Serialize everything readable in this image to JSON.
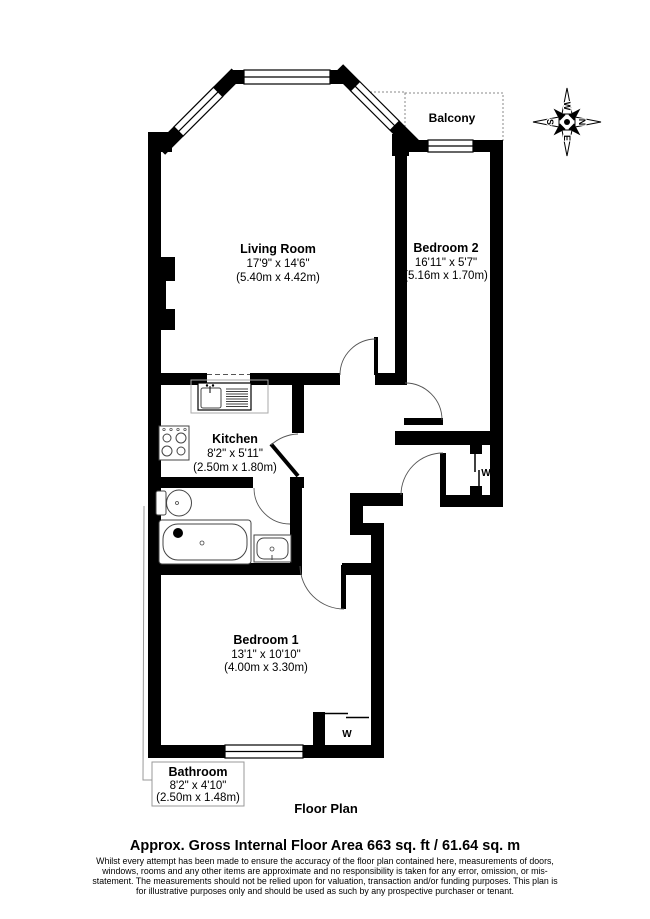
{
  "plan": {
    "rooms": [
      {
        "name": "Living Room",
        "imperial": "17'9\" x 14'6\"",
        "metric": "(5.40m x 4.42m)"
      },
      {
        "name": "Bedroom 2",
        "imperial": "16'11\" x 5'7\"",
        "metric": "(5.16m x 1.70m)"
      },
      {
        "name": "Kitchen",
        "imperial": "8'2\" x 5'11\"",
        "metric": "(2.50m x 1.80m)"
      },
      {
        "name": "Bedroom 1",
        "imperial": "13'1\" x 10'10\"",
        "metric": "(4.00m x 3.30m)"
      },
      {
        "name": "Bathroom",
        "imperial": "8'2\" x 4'10\"",
        "metric": "(2.50m x 1.48m)"
      }
    ],
    "balcony_label": "Balcony",
    "wardrobe_label": "W",
    "floor_plan_label": "Floor Plan",
    "compass": {
      "n": "N",
      "e": "E",
      "s": "S",
      "w": "W"
    }
  },
  "footer": {
    "area_title": "Approx. Gross Internal Floor Area 663 sq. ft / 61.64 sq. m",
    "disclaimer": "Whilst every attempt has been made to ensure the accuracy of the floor plan contained here, measurements of doors, windows, rooms and any other items are approximate and no responsibility is taken for any error, omission, or mis-statement. The measurements should not be relied upon for valuation, transaction and/or funding purposes. This plan is for illustrative purposes only and should be used as such by any prospective purchaser or tenant."
  },
  "colors": {
    "wall": "#000000",
    "background": "#ffffff"
  }
}
